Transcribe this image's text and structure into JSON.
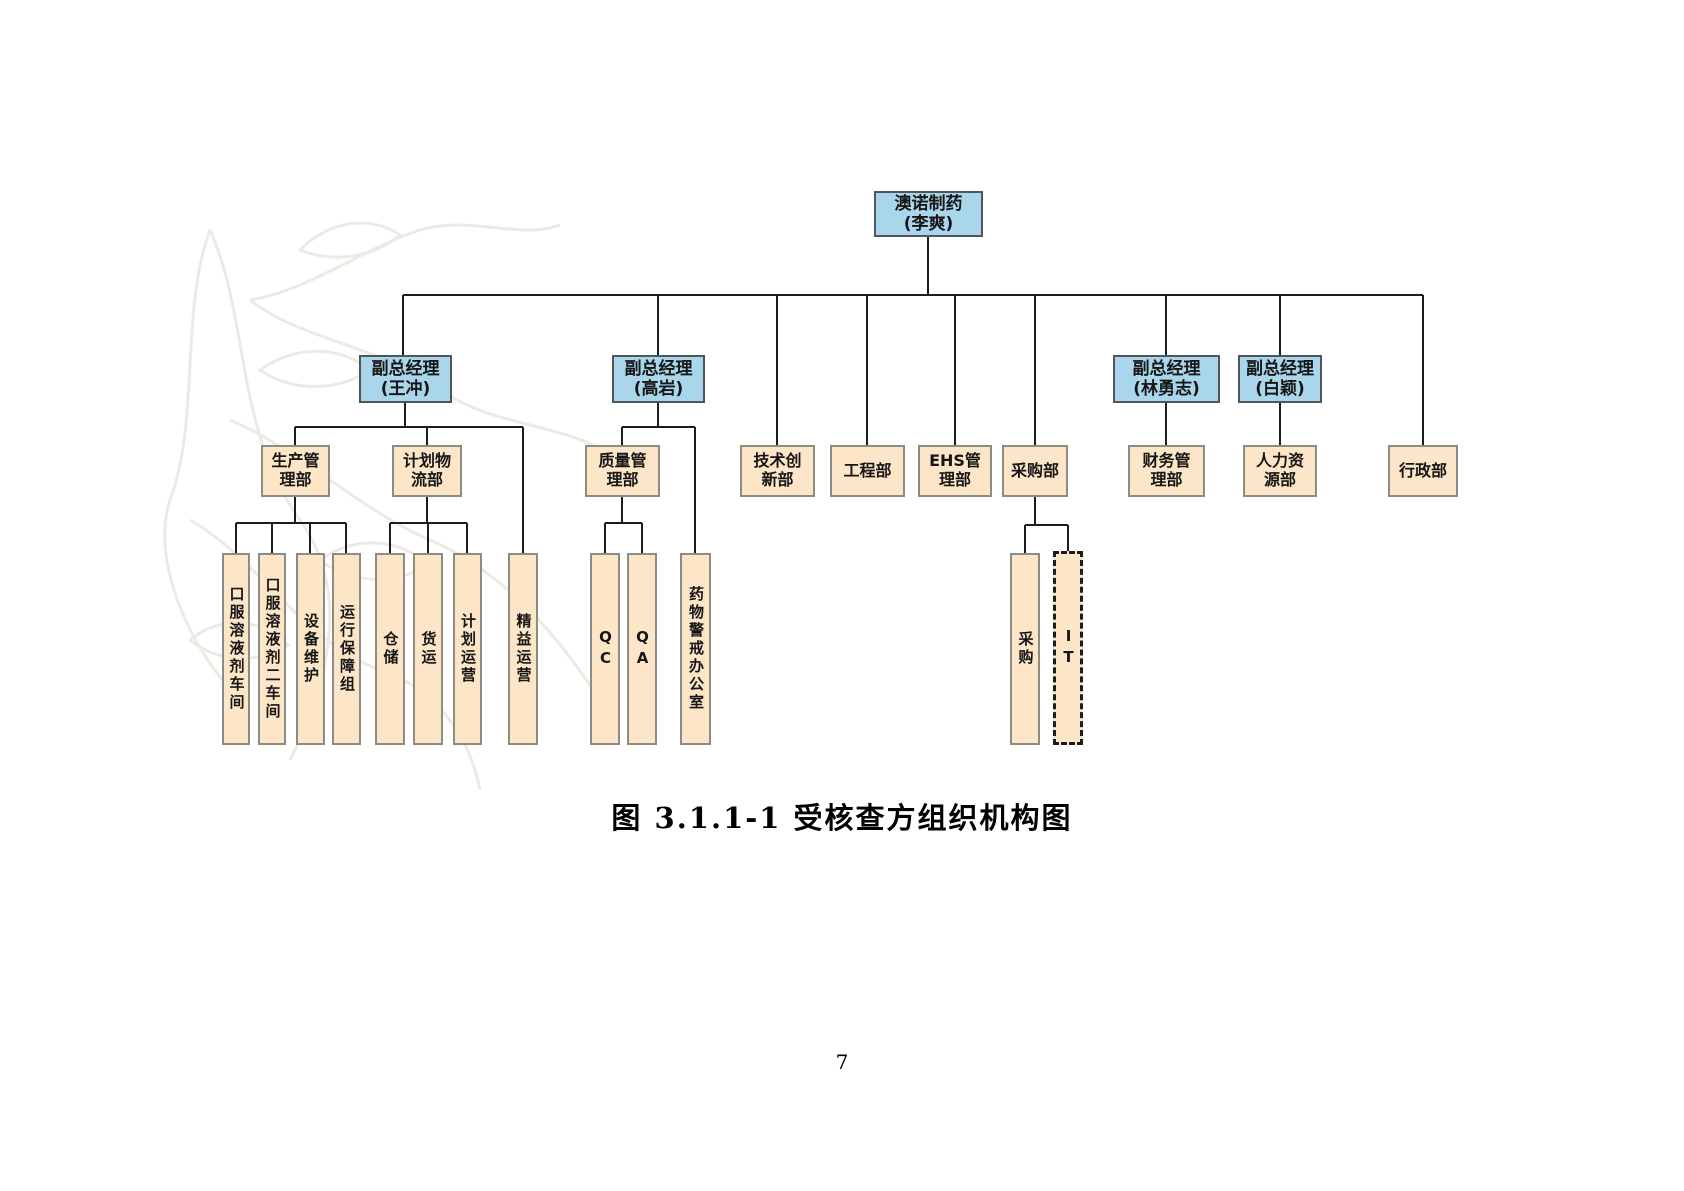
{
  "caption": "图 3.1.1-1  受核查方组织机构图",
  "page_number": "7",
  "colors": {
    "exec_fill": "#a9d6ea",
    "exec_border": "#4e555c",
    "dept_fill": "#fce6c7",
    "dept_border": "#8d8c82",
    "connector": "#1c1c1c"
  },
  "org_chart": {
    "structure": {
      "澳诺制药(李爽)": [
        "副总经理(王冲)",
        "副总经理(高岩)",
        "技术创新部",
        "工程部",
        "EHS管理部",
        "采购部",
        "副总经理(林勇志)",
        "副总经理(白颖)",
        "行政部"
      ],
      "副总经理(王冲)": [
        "生产管理部",
        "计划物流部",
        "精益运营"
      ],
      "生产管理部": [
        "口服溶液剂车间",
        "口服溶液剂二车间",
        "设备维护",
        "运行保障组"
      ],
      "计划物流部": [
        "仓储",
        "货运",
        "计划运营"
      ],
      "副总经理(高岩)": [
        "质量管理部",
        "药物警戒办公室"
      ],
      "质量管理部": [
        "QC",
        "QA"
      ],
      "采购部": [
        "采购",
        "IT"
      ],
      "副总经理(林勇志)": [
        "财务管理部"
      ],
      "副总经理(白颖)": [
        "人力资源部"
      ]
    },
    "nodes": [
      {
        "id": "root-aonuo-pharma",
        "label": "澳诺制药\n(李爽)",
        "type": "exec",
        "orient": "h",
        "x": 874,
        "y": 191,
        "w": 109,
        "h": 46
      },
      {
        "id": "vp-wangchong",
        "label": "副总经理\n(王冲)",
        "type": "exec",
        "orient": "h",
        "x": 359,
        "y": 355,
        "w": 93,
        "h": 48
      },
      {
        "id": "vp-gaoyan",
        "label": "副总经理\n(高岩)",
        "type": "exec",
        "orient": "h",
        "x": 612,
        "y": 355,
        "w": 93,
        "h": 48
      },
      {
        "id": "vp-linyongzhi",
        "label": "副总经理\n(林勇志)",
        "type": "exec",
        "orient": "h",
        "x": 1113,
        "y": 355,
        "w": 107,
        "h": 48
      },
      {
        "id": "vp-baiying",
        "label": "副总经理\n(白颖)",
        "type": "exec",
        "orient": "h",
        "x": 1238,
        "y": 355,
        "w": 84,
        "h": 48
      },
      {
        "id": "production-mgmt-dept",
        "label": "生产管\n理部",
        "type": "dept",
        "orient": "h",
        "x": 261,
        "y": 445,
        "w": 69,
        "h": 52
      },
      {
        "id": "planning-logistics-dept",
        "label": "计划物\n流部",
        "type": "dept",
        "orient": "h",
        "x": 392,
        "y": 445,
        "w": 70,
        "h": 52
      },
      {
        "id": "quality-mgmt-dept",
        "label": "质量管\n理部",
        "type": "dept",
        "orient": "h",
        "x": 585,
        "y": 445,
        "w": 75,
        "h": 52
      },
      {
        "id": "tech-innovation-dept",
        "label": "技术创\n新部",
        "type": "dept",
        "orient": "h",
        "x": 740,
        "y": 445,
        "w": 75,
        "h": 52
      },
      {
        "id": "engineering-dept",
        "label": "工程部",
        "type": "dept",
        "orient": "h",
        "x": 830,
        "y": 445,
        "w": 75,
        "h": 52
      },
      {
        "id": "ehs-mgmt-dept",
        "label": "EHS管\n理部",
        "type": "dept",
        "orient": "h",
        "x": 918,
        "y": 445,
        "w": 74,
        "h": 52
      },
      {
        "id": "procurement-dept",
        "label": "采购部",
        "type": "dept",
        "orient": "h",
        "x": 1002,
        "y": 445,
        "w": 66,
        "h": 52
      },
      {
        "id": "finance-mgmt-dept",
        "label": "财务管\n理部",
        "type": "dept",
        "orient": "h",
        "x": 1128,
        "y": 445,
        "w": 77,
        "h": 52
      },
      {
        "id": "hr-dept",
        "label": "人力资\n源部",
        "type": "dept",
        "orient": "h",
        "x": 1243,
        "y": 445,
        "w": 74,
        "h": 52
      },
      {
        "id": "admin-dept",
        "label": "行政部",
        "type": "dept",
        "orient": "h",
        "x": 1388,
        "y": 445,
        "w": 70,
        "h": 52
      },
      {
        "id": "oral-solution-workshop-1",
        "label": "口服溶液剂车间",
        "type": "dept",
        "orient": "v",
        "x": 222,
        "y": 553,
        "w": 28,
        "h": 192
      },
      {
        "id": "oral-solution-workshop-2",
        "label": "口服溶液剂二车间",
        "type": "dept",
        "orient": "v",
        "x": 258,
        "y": 553,
        "w": 28,
        "h": 192
      },
      {
        "id": "equipment-maintenance",
        "label": "设备维护",
        "type": "dept",
        "orient": "v",
        "x": 296,
        "y": 553,
        "w": 29,
        "h": 192
      },
      {
        "id": "operation-support-group",
        "label": "运行保障组",
        "type": "dept",
        "orient": "v",
        "x": 332,
        "y": 553,
        "w": 29,
        "h": 192
      },
      {
        "id": "warehousing",
        "label": "仓储",
        "type": "dept",
        "orient": "v",
        "x": 375,
        "y": 553,
        "w": 30,
        "h": 192
      },
      {
        "id": "freight",
        "label": "货运",
        "type": "dept",
        "orient": "v",
        "x": 413,
        "y": 553,
        "w": 30,
        "h": 192
      },
      {
        "id": "planning-operations",
        "label": "计划运营",
        "type": "dept",
        "orient": "v",
        "x": 453,
        "y": 553,
        "w": 29,
        "h": 192
      },
      {
        "id": "lean-operations",
        "label": "精益运营",
        "type": "dept",
        "orient": "v",
        "x": 508,
        "y": 553,
        "w": 30,
        "h": 192
      },
      {
        "id": "qc",
        "label": "QC",
        "type": "dept",
        "orient": "v",
        "x": 590,
        "y": 553,
        "w": 30,
        "h": 192
      },
      {
        "id": "qa",
        "label": "QA",
        "type": "dept",
        "orient": "v",
        "x": 627,
        "y": 553,
        "w": 30,
        "h": 192
      },
      {
        "id": "pharmacovigilance-office",
        "label": "药物警戒办公室",
        "type": "dept",
        "orient": "v",
        "x": 680,
        "y": 553,
        "w": 31,
        "h": 192
      },
      {
        "id": "purchasing",
        "label": "采购",
        "type": "dept",
        "orient": "v",
        "x": 1010,
        "y": 553,
        "w": 30,
        "h": 192
      },
      {
        "id": "it",
        "label": "IT",
        "type": "dept",
        "orient": "v",
        "dashed": true,
        "x": 1053,
        "y": 551,
        "w": 30,
        "h": 194
      }
    ],
    "connectors": [
      [
        928,
        237,
        928,
        295
      ],
      [
        403,
        295,
        1423,
        295
      ],
      [
        403,
        295,
        403,
        355
      ],
      [
        658,
        295,
        658,
        355
      ],
      [
        777,
        295,
        777,
        445
      ],
      [
        867,
        295,
        867,
        445
      ],
      [
        955,
        295,
        955,
        445
      ],
      [
        1035,
        295,
        1035,
        445
      ],
      [
        1166,
        295,
        1166,
        355
      ],
      [
        1280,
        295,
        1280,
        355
      ],
      [
        1423,
        295,
        1423,
        445
      ],
      [
        405,
        403,
        405,
        427
      ],
      [
        295,
        427,
        523,
        427
      ],
      [
        295,
        427,
        295,
        445
      ],
      [
        427,
        427,
        427,
        445
      ],
      [
        523,
        427,
        523,
        553
      ],
      [
        658,
        403,
        658,
        427
      ],
      [
        622,
        427,
        695,
        427
      ],
      [
        622,
        427,
        622,
        445
      ],
      [
        695,
        427,
        695,
        553
      ],
      [
        1166,
        403,
        1166,
        445
      ],
      [
        1280,
        403,
        1280,
        445
      ],
      [
        295,
        497,
        295,
        523
      ],
      [
        236,
        523,
        346,
        523
      ],
      [
        236,
        523,
        236,
        553
      ],
      [
        272,
        523,
        272,
        553
      ],
      [
        310,
        523,
        310,
        553
      ],
      [
        346,
        523,
        346,
        553
      ],
      [
        427,
        497,
        427,
        523
      ],
      [
        390,
        523,
        467,
        523
      ],
      [
        390,
        523,
        390,
        553
      ],
      [
        428,
        523,
        428,
        553
      ],
      [
        467,
        523,
        467,
        553
      ],
      [
        622,
        497,
        622,
        523
      ],
      [
        605,
        523,
        642,
        523
      ],
      [
        605,
        523,
        605,
        553
      ],
      [
        642,
        523,
        642,
        553
      ],
      [
        1035,
        497,
        1035,
        525
      ],
      [
        1025,
        525,
        1068,
        525
      ],
      [
        1025,
        525,
        1025,
        553
      ],
      [
        1068,
        525,
        1068,
        553
      ]
    ]
  }
}
